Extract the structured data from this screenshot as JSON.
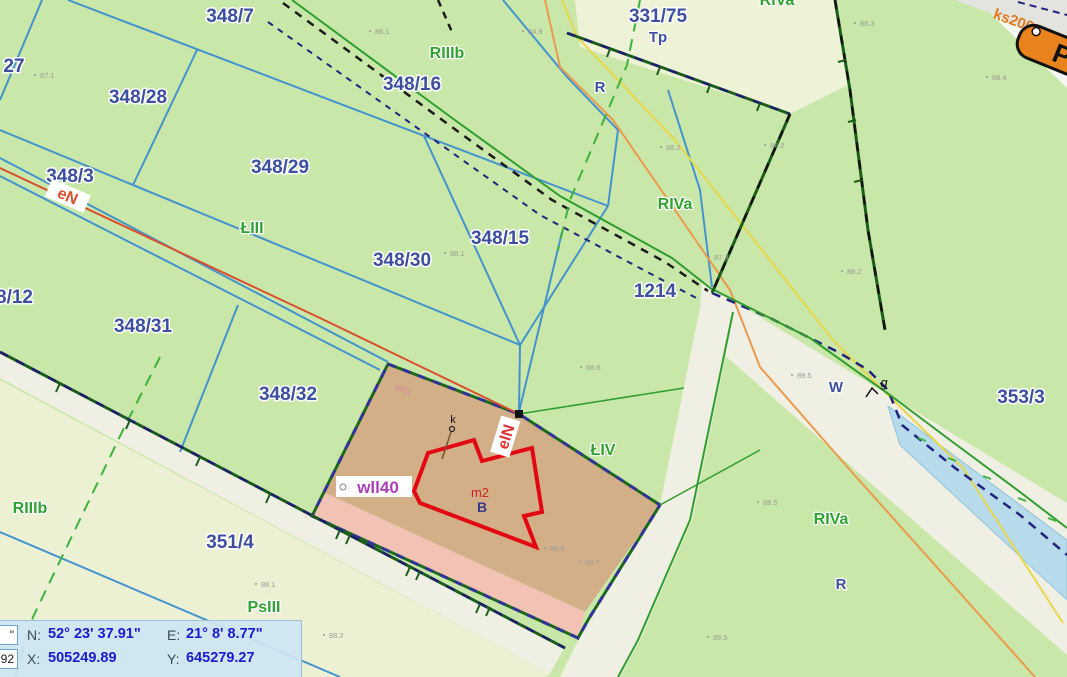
{
  "parcels": {
    "p27": "27",
    "p348_7": "348/7",
    "p348_28": "348/28",
    "p348_29": "348/29",
    "p348_3": "348/3",
    "p8_12": "8/12",
    "p348_30": "348/30",
    "p348_15": "348/15",
    "p348_16": "348/16",
    "p331_75": "331/75",
    "p1214": "1214",
    "p348_31": "348/31",
    "p348_32": "348/32",
    "p353_3": "353/3",
    "p351_4": "351/4",
    "small_id": "4601"
  },
  "soil": {
    "riiib_top": "RIIIb",
    "riiib_left": "RIIIb",
    "liii": "ŁIII",
    "liv": "ŁIV",
    "riva_mid": "RIVa",
    "riva_top": "RIVa",
    "riva_bottom": "RIVa",
    "psiii": "PsIII",
    "tp": "Tp",
    "r_top": "R",
    "r_bottom": "R",
    "w_ditch": "W",
    "g_gate": "g"
  },
  "utilities": {
    "power_line": "eN",
    "power_line_2": "elN",
    "water_pipe": "wll40",
    "sewer": "ks200",
    "building_area": "m2",
    "building_type": "B",
    "chimney": "k",
    "road_sign": "P"
  },
  "elev": [
    "87.1",
    "86.1",
    "84.9",
    "88.1",
    "88.2",
    "86.2",
    "88.3",
    "88.4",
    "88.2",
    "89.5",
    "88.6",
    "87.3",
    "88.6",
    "88.7",
    "88.1",
    "88.2",
    "88.5",
    "89.5"
  ],
  "statusbar": {
    "unit_box": "\"",
    "crs_box": "92",
    "n_label": "N:",
    "n_value": "52° 23' 37.91\"",
    "e_label": "E:",
    "e_value": "21° 8' 8.77\"",
    "x_label": "X:",
    "x_value": "505249.89",
    "y_label": "Y:",
    "y_value": "645279.27"
  },
  "colors": {
    "base_green": "#c9e7a8",
    "pale_green": "#eef2d6",
    "road_beige": "#f0efe3",
    "selected_tan": "#d2af87",
    "selected_pink": "#f2c2b4",
    "parcel_blue": "#4493ce",
    "label_navy": "#3d4f9f",
    "soil_green": "#2fa32f",
    "building_red": "#e30613",
    "power_red": "#d94f2b",
    "ditch_blue": "#b8dbeb",
    "status_value_blue": "#1b1bd1"
  }
}
